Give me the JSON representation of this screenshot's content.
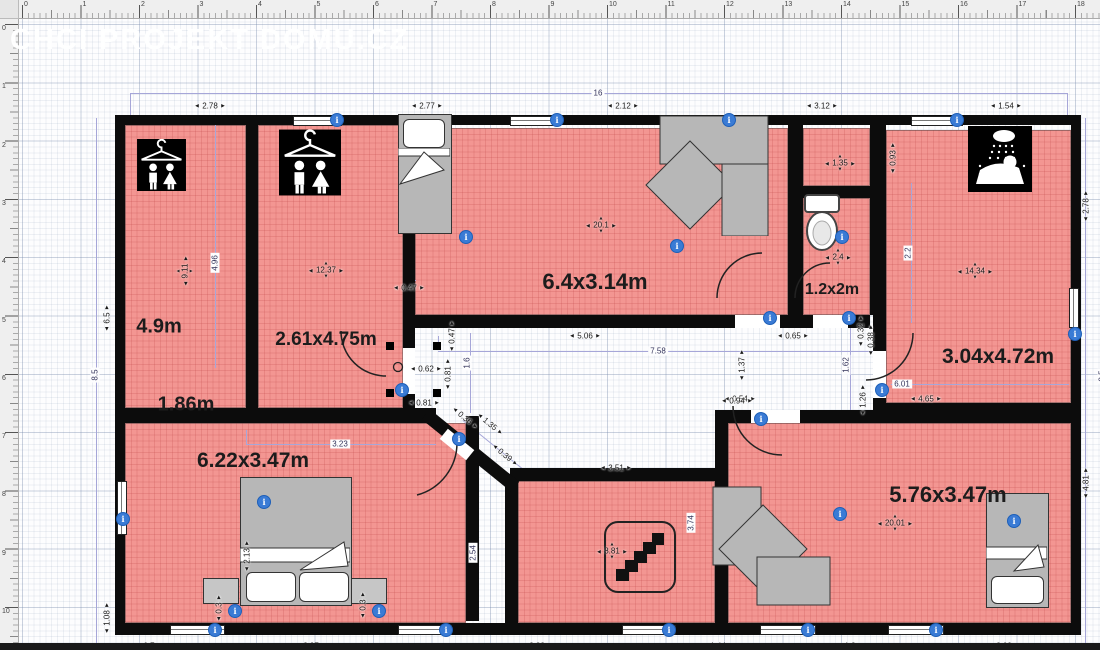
{
  "watermark": "CHCI PROJEKT DOMU.CZ",
  "colors": {
    "room_fill": "#f39692",
    "wall": "#0c0c0c",
    "accent_blue": "#3a7bd5",
    "dimension_line": "#a6a6d8",
    "furniture_gray": "#b7b7b7"
  },
  "rulers": {
    "top": [
      "0",
      "1",
      "2",
      "3",
      "4",
      "5",
      "6",
      "7",
      "8",
      "9",
      "10",
      "11",
      "12",
      "13",
      "14",
      "15",
      "16",
      "17",
      "18"
    ],
    "left": [
      "0",
      "1",
      "2",
      "3",
      "4",
      "5",
      "6",
      "7",
      "8",
      "9",
      "10"
    ]
  },
  "room_labels": [
    {
      "text": "4.9m",
      "x": 141,
      "y": 309,
      "size": 20
    },
    {
      "text": "1.86m",
      "x": 168,
      "y": 387,
      "size": 20
    },
    {
      "text": "2.61x4.75m",
      "x": 308,
      "y": 322,
      "size": 19
    },
    {
      "text": "6.4x3.14m",
      "x": 577,
      "y": 264,
      "size": 22
    },
    {
      "text": "1.2x2m",
      "x": 814,
      "y": 272,
      "size": 16
    },
    {
      "text": "3.04x4.72m",
      "x": 980,
      "y": 339,
      "size": 21
    },
    {
      "text": "6.22x3.47m",
      "x": 235,
      "y": 443,
      "size": 21
    },
    {
      "text": "5.76x3.47m",
      "x": 930,
      "y": 477,
      "size": 22
    }
  ],
  "area_labels": [
    {
      "text": "9.11",
      "x": 167,
      "y": 253,
      "rot": true
    },
    {
      "text": "12.37",
      "x": 308,
      "y": 252
    },
    {
      "text": "20.1",
      "x": 583,
      "y": 207
    },
    {
      "text": "1.35",
      "x": 822,
      "y": 145
    },
    {
      "text": "2.4",
      "x": 820,
      "y": 239
    },
    {
      "text": "14.34",
      "x": 957,
      "y": 253
    },
    {
      "text": "8.81",
      "x": 594,
      "y": 533
    },
    {
      "text": "20.01",
      "x": 877,
      "y": 505
    }
  ],
  "dims_h": [
    {
      "text": "2.78",
      "x": 192,
      "y": 88
    },
    {
      "text": "2.77",
      "x": 409,
      "y": 88
    },
    {
      "text": "2.12",
      "x": 605,
      "y": 88
    },
    {
      "text": "3.12",
      "x": 804,
      "y": 88
    },
    {
      "text": "1.54",
      "x": 988,
      "y": 88
    },
    {
      "text": "0.7",
      "x": 131,
      "y": 628
    },
    {
      "text": "2.97",
      "x": 293,
      "y": 628
    },
    {
      "text": "2.83",
      "x": 519,
      "y": 628
    },
    {
      "text": "1.44",
      "x": 700,
      "y": 628
    },
    {
      "text": "1.3",
      "x": 832,
      "y": 628
    },
    {
      "text": "2.09",
      "x": 986,
      "y": 628
    },
    {
      "text": "5.06",
      "x": 567,
      "y": 318
    },
    {
      "text": "0.65",
      "x": 775,
      "y": 318
    },
    {
      "text": "0.54",
      "x": 722,
      "y": 381
    },
    {
      "text": "0.62",
      "x": 408,
      "y": 351
    },
    {
      "text": "0.81",
      "x": 406,
      "y": 385
    },
    {
      "text": "3.51",
      "x": 598,
      "y": 450
    },
    {
      "text": "0.94",
      "x": 719,
      "y": 383
    },
    {
      "text": "4.65",
      "x": 908,
      "y": 381
    },
    {
      "text": "0.47",
      "x": 391,
      "y": 270
    }
  ],
  "dims_v": [
    {
      "text": "0.47",
      "x": 434,
      "y": 318
    },
    {
      "text": "0.81",
      "x": 430,
      "y": 356
    },
    {
      "text": "1.37",
      "x": 724,
      "y": 347
    },
    {
      "text": "0.32",
      "x": 843,
      "y": 313
    },
    {
      "text": "0.38",
      "x": 853,
      "y": 322
    },
    {
      "text": "1.26",
      "x": 845,
      "y": 382
    },
    {
      "text": "0.93",
      "x": 875,
      "y": 140
    },
    {
      "text": "6.5",
      "x": 89,
      "y": 300
    },
    {
      "text": "1.08",
      "x": 89,
      "y": 600
    },
    {
      "text": "2.78",
      "x": 1068,
      "y": 188
    },
    {
      "text": "4.81",
      "x": 1068,
      "y": 465
    },
    {
      "text": "0.3",
      "x": 201,
      "y": 590
    },
    {
      "text": "0.3",
      "x": 345,
      "y": 587
    },
    {
      "text": "2.13",
      "x": 229,
      "y": 538
    }
  ],
  "dims_diag": [
    {
      "text": "0.36",
      "x": 447,
      "y": 400
    },
    {
      "text": "1.35",
      "x": 472,
      "y": 406
    },
    {
      "text": "0.39",
      "x": 487,
      "y": 437
    }
  ],
  "line_labels": [
    {
      "text": "16",
      "x": 580,
      "y": 75
    },
    {
      "text": "16",
      "x": 580,
      "y": 641
    },
    {
      "text": "7.58",
      "x": 640,
      "y": 333
    },
    {
      "text": "3.23",
      "x": 322,
      "y": 426
    },
    {
      "text": "6.01",
      "x": 884,
      "y": 366
    },
    {
      "text": "8.5",
      "x": 77,
      "y": 357,
      "rot": true
    },
    {
      "text": "8.5",
      "x": 1084,
      "y": 358,
      "rot": true
    },
    {
      "text": "4.96",
      "x": 197,
      "y": 245,
      "rot": true
    },
    {
      "text": "2.2",
      "x": 890,
      "y": 235,
      "rot": true
    },
    {
      "text": "1.62",
      "x": 828,
      "y": 347,
      "rot": true
    },
    {
      "text": "1.6",
      "x": 449,
      "y": 345,
      "rot": true
    },
    {
      "text": "3.74",
      "x": 673,
      "y": 505,
      "rot": true
    },
    {
      "text": "2.54",
      "x": 455,
      "y": 535,
      "rot": true
    }
  ],
  "info_icons": [
    [
      318,
      101
    ],
    [
      538,
      101
    ],
    [
      710,
      101
    ],
    [
      938,
      101
    ],
    [
      104,
      500
    ],
    [
      1056,
      315
    ],
    [
      196,
      611
    ],
    [
      427,
      611
    ],
    [
      650,
      611
    ],
    [
      789,
      611
    ],
    [
      917,
      611
    ],
    [
      447,
      218
    ],
    [
      658,
      227
    ],
    [
      823,
      218
    ],
    [
      751,
      299
    ],
    [
      830,
      299
    ],
    [
      863,
      371
    ],
    [
      742,
      400
    ],
    [
      440,
      420
    ],
    [
      383,
      371
    ],
    [
      245,
      483
    ],
    [
      216,
      592
    ],
    [
      360,
      592
    ],
    [
      821,
      495
    ],
    [
      995,
      502
    ]
  ]
}
